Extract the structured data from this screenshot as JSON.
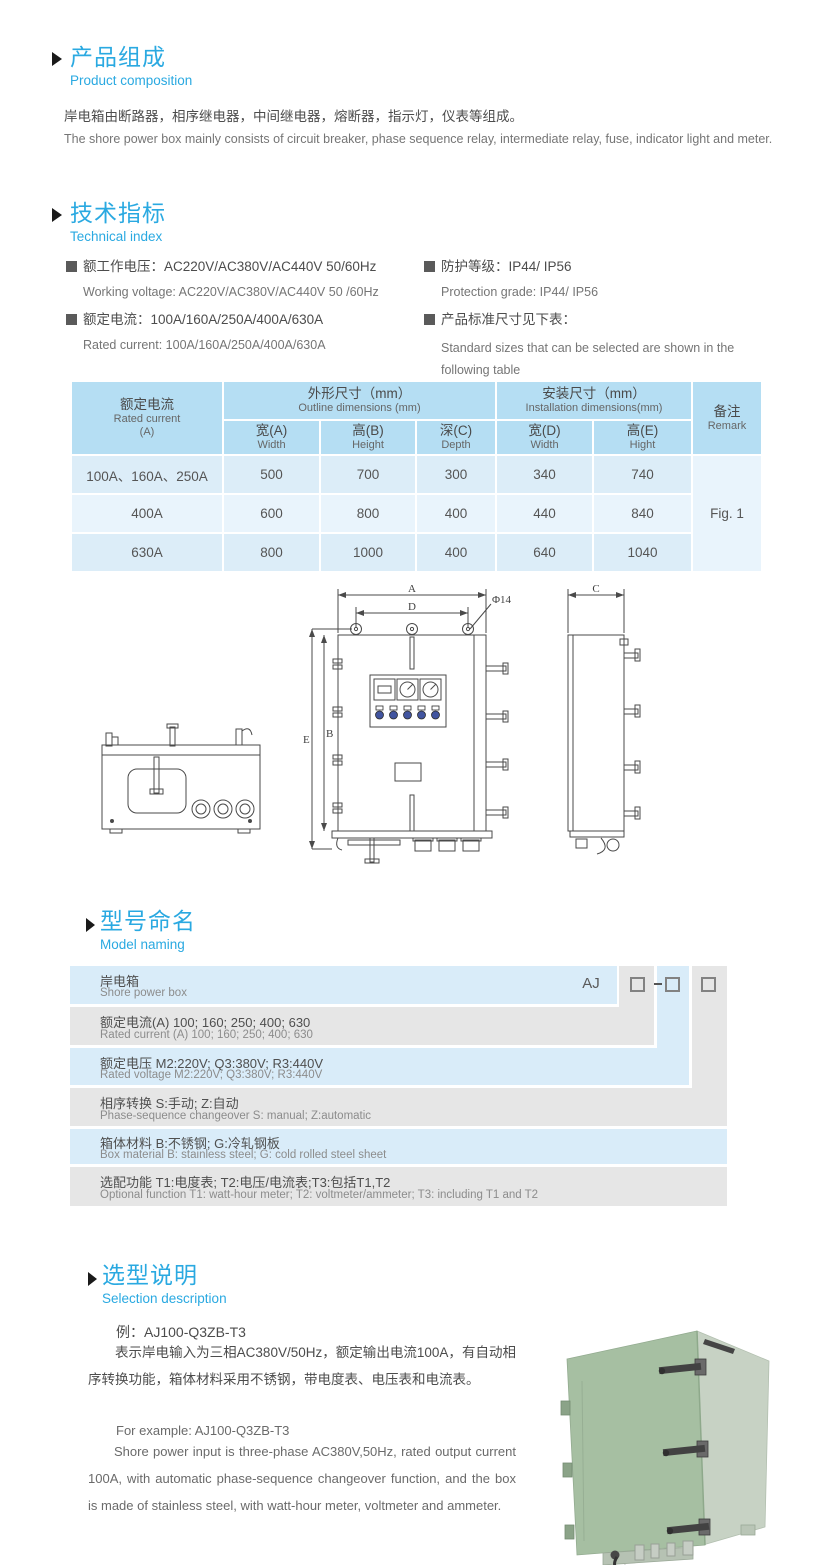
{
  "composition": {
    "title_cn": "产品组成",
    "title_en": "Product  composition",
    "body_cn": "岸电箱由断路器，相序继电器，中间继电器，熔断器，指示灯，仪表等组成。",
    "body_en": "The shore power box mainly consists of circuit breaker, phase sequence relay, intermediate relay, fuse, indicator light and meter."
  },
  "technical": {
    "title_cn": "技术指标",
    "title_en": "Technical index",
    "items": [
      {
        "cn": "额工作电压：AC220V/AC380V/AC440V  50/60Hz",
        "en": "Working voltage: AC220V/AC380V/AC440V 50 /60Hz"
      },
      {
        "cn": "额定电流：100A/160A/250A/400A/630A",
        "en": "Rated current: 100A/160A/250A/400A/630A"
      },
      {
        "cn": "防护等级：IP44/ IP56",
        "en": "Protection grade: IP44/ IP56"
      },
      {
        "cn": "产品标准尺寸见下表：",
        "en": "Standard sizes that can be selected are shown in the following table"
      }
    ]
  },
  "size_table": {
    "header": {
      "current_cn": "额定电流",
      "current_en": "Rated current",
      "current_unit": "(A)",
      "outline_cn": "外形尺寸（mm）",
      "outline_en": "Outline dimensions (mm)",
      "install_cn": "安装尺寸（mm）",
      "install_en": "Installation dimensions(mm)",
      "remark_cn": "备注",
      "remark_en": "Remark",
      "sub": [
        {
          "cn": "宽(A)",
          "en": "Width"
        },
        {
          "cn": "高(B)",
          "en": "Height"
        },
        {
          "cn": "深(C)",
          "en": "Depth"
        },
        {
          "cn": "宽(D)",
          "en": "Width"
        },
        {
          "cn": "高(E)",
          "en": "Hight"
        }
      ]
    },
    "rows": [
      {
        "current": "100A、160A、250A",
        "a": "500",
        "b": "700",
        "c": "300",
        "d": "340",
        "e": "740"
      },
      {
        "current": "400A",
        "a": "600",
        "b": "800",
        "c": "400",
        "d": "440",
        "e": "840"
      },
      {
        "current": "630A",
        "a": "800",
        "b": "1000",
        "c": "400",
        "d": "640",
        "e": "1040"
      }
    ],
    "remark_value": "Fig. 1"
  },
  "drawing": {
    "labels": {
      "dim_a": "A",
      "dim_b": "B",
      "dim_c": "C",
      "dim_d": "D",
      "dim_e": "E",
      "hole": "Φ14"
    }
  },
  "model_naming": {
    "title_cn": "型号命名",
    "title_en": "Model naming",
    "code_prefix": "AJ",
    "rows": [
      {
        "cn": "岸电箱",
        "en": "Shore power box"
      },
      {
        "cn": "额定电流(A)  100; 160; 250; 400; 630",
        "en": "Rated current (A) 100; 160; 250; 400; 630"
      },
      {
        "cn": "额定电压   M2:220V;  Q3:380V;  R3:440V",
        "en": "Rated voltage  M2:220V;  Q3:380V;  R3:440V"
      },
      {
        "cn": "相序转换  S:手动; Z:自动",
        "en": "Phase-sequence changeover  S: manual;  Z:automatic"
      },
      {
        "cn": "箱体材料    B:不锈钢;  G:冷轧钢板",
        "en": "Box material   B: stainless steel; G: cold rolled steel sheet"
      },
      {
        "cn": "选配功能      T1:电度表;  T2:电压/电流表;T3:包括T1,T2",
        "en": "Optional function  T1: watt-hour meter; T2: voltmeter/ammeter; T3: including T1 and T2"
      }
    ]
  },
  "selection": {
    "title_cn": "选型说明",
    "title_en": "Selection description",
    "example_cn": "例：AJ100-Q3ZB-T3",
    "body_cn": "表示岸电输入为三相AC380V/50Hz，额定输出电流100A，有自动相序转换功能，箱体材料采用不锈钢，带电度表、电压表和电流表。",
    "example_en": "For example: AJ100-Q3ZB-T3",
    "body_en": "Shore power input is three-phase AC380V,50Hz, rated output current 100A, with automatic phase-sequence changeover function, and the box is made of stainless steel, with watt-hour meter, voltmeter and ammeter."
  }
}
